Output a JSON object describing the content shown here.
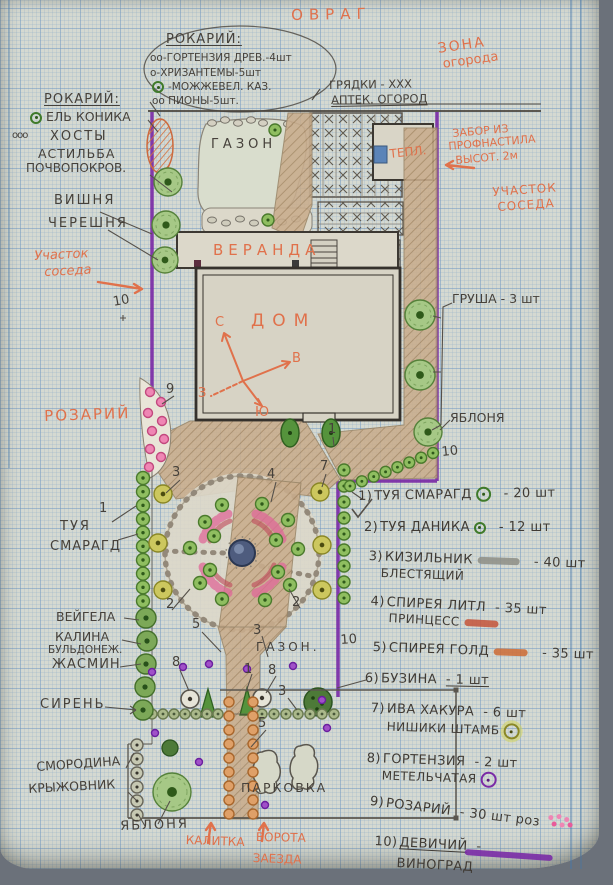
{
  "colors": {
    "paper": "#d5d9d1",
    "grid": "#6c96c1",
    "pencil": "#46413b",
    "orange": "#e0714b",
    "purple": "#7a2ba6",
    "green": "#4a7a2c",
    "pink": "#ef86b4",
    "path_tan": "#c9ad8d",
    "center_blue": "#4e5c7e"
  },
  "top": {
    "ravine": "ОВРАГ",
    "rockery_title": "РОКАРИЙ:",
    "rockery_items": [
      "оо-ГОРТЕНЗИЯ ДРЕВ.-4шт",
      "о-ХРИЗАНТЕМЫ-5шт",
      "-МОЖЖЕВЕЛ. КАЗ.",
      "оо ПИОНЫ-5шт."
    ],
    "beds": "ГРЯДКИ - ХХХ",
    "beds_sub": "АПТЕК. ОГОРОД",
    "zone1": "ЗОНА",
    "zone2": "огорода",
    "fence1": "ЗАБОР ИЗ",
    "fence2": "ПРОФНАСТИЛА",
    "fence3": "ВЫСОТ. 2м",
    "neighbor1": "УЧАСТОК",
    "neighbor2": "СОСЕДА"
  },
  "left": {
    "rockery_title": "РОКАРИЙ:",
    "spruce": "ЕЛЬ КОНИКА",
    "hosta_sym": "ооо",
    "hostas": "ХОСТЫ",
    "astilba": "АСТИЛЬБА",
    "groundcover": "ПОЧВОПОКРОВ.",
    "cherry": "ВИШНЯ",
    "sweet_cherry": "ЧЕРЕШНЯ",
    "neighbor1": "Участок",
    "neighbor2": "соседа",
    "rosary": "РОЗАРИЙ",
    "thuja1": "ТУЯ",
    "thuja2": "СМАРАГД",
    "weigela": "ВЕЙГЕЛА",
    "kalina": "КАЛИНА",
    "kalina2": "БУЛЬДОНЕЖ.",
    "jasmine": "ЖАСМИН",
    "lilac": "СИРЕНЬ",
    "currant": "СМОРОДИНА",
    "gooseberry": "КРЫЖОВНИК",
    "apple": "ЯБЛОНЯ"
  },
  "plan": {
    "lawn_top": "ГАЗОН",
    "veranda": "ВЕРАНДА",
    "greenhouse": "ТЕПЛ.",
    "house": "ДОМ",
    "pear": "ГРУША - 3 шт",
    "apple_right": "ЯБЛОНЯ",
    "lawn_bottom": "ГАЗОН.",
    "parking": "ПАРКОВКА",
    "gate1": "КАЛИТКА",
    "gate2": "ВОРОТА",
    "gate3": "ЗАЕЗДА"
  },
  "compass": {
    "n": "С",
    "e": "В",
    "w": "З",
    "s": "Ю"
  },
  "numbers": {
    "one": "1",
    "two": "2",
    "three": "3",
    "four": "4",
    "five": "5",
    "six": "б",
    "seven": "7",
    "eight": "8",
    "nine": "9",
    "ten": "10"
  },
  "legend": [
    {
      "num": "1)",
      "name": "ТУЯ СМАРАГД",
      "name2": "",
      "qty": "- 20 шт"
    },
    {
      "num": "2)",
      "name": "ТУЯ ДАНИКА",
      "name2": "",
      "qty": "- 12 шт"
    },
    {
      "num": "3)",
      "name": "КИЗИЛЬНИК",
      "name2": "БЛЕСТЯЩИЙ",
      "qty": "- 40 шт"
    },
    {
      "num": "4)",
      "name": "СПИРЕЯ ЛИТЛ",
      "name2": "ПРИНЦЕСС",
      "qty": "- 35 шт"
    },
    {
      "num": "5)",
      "name": "СПИРЕЯ ГОЛД",
      "name2": "",
      "qty": "- 35 шт"
    },
    {
      "num": "6)",
      "name": "БУЗИНА",
      "name2": "",
      "qty": "- 1 шт"
    },
    {
      "num": "7)",
      "name": "ИВА ХАКУРА",
      "name2": "НИШИКИ ШТАМБ",
      "qty": "- 6 шт"
    },
    {
      "num": "8)",
      "name": "ГОРТЕНЗИЯ",
      "name2": "МЕТЕЛЬЧАТАЯ",
      "qty": "- 2 шт"
    },
    {
      "num": "9)",
      "name": "РОЗАРИЙ",
      "name2": "",
      "qty": "- 30 шт роз"
    },
    {
      "num": "10)",
      "name": "ДЕВИЧИЙ",
      "name2": "ВИНОГРАД",
      "qty": "-"
    }
  ]
}
